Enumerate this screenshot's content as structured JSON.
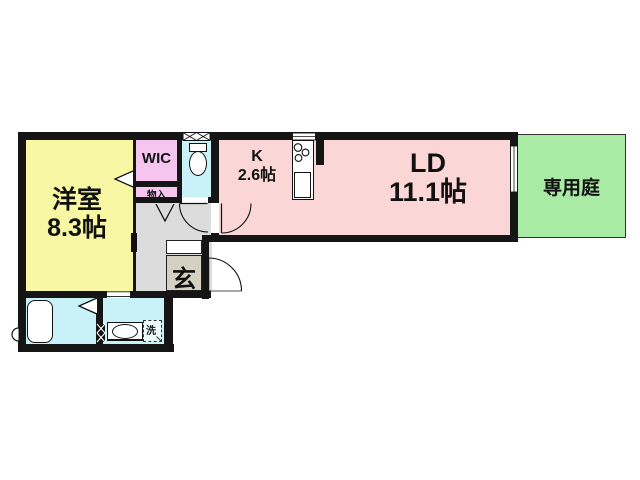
{
  "floorplan": {
    "rooms": {
      "western_room": {
        "label": "洋室",
        "size": "8.3帖"
      },
      "wic": {
        "label": "WIC"
      },
      "storage": {
        "label": "物入"
      },
      "kitchen": {
        "label": "K",
        "size": "2.6帖"
      },
      "living_dining": {
        "label": "LD",
        "size": "11.1帖"
      },
      "private_garden": {
        "label": "専用庭"
      },
      "entrance": {
        "label": "玄"
      },
      "laundry": {
        "label": "洗"
      }
    },
    "colors": {
      "wall": "#151515",
      "western_room": "#f8f7a3",
      "wic": "#f5c4ef",
      "wet_area_blue": "#c9f2f8",
      "living_pink": "#fad7d6",
      "garden_green": "#a9eba4",
      "hall_gray": "#dcdcdc",
      "entrance_beige": "#d5d1c1"
    }
  }
}
